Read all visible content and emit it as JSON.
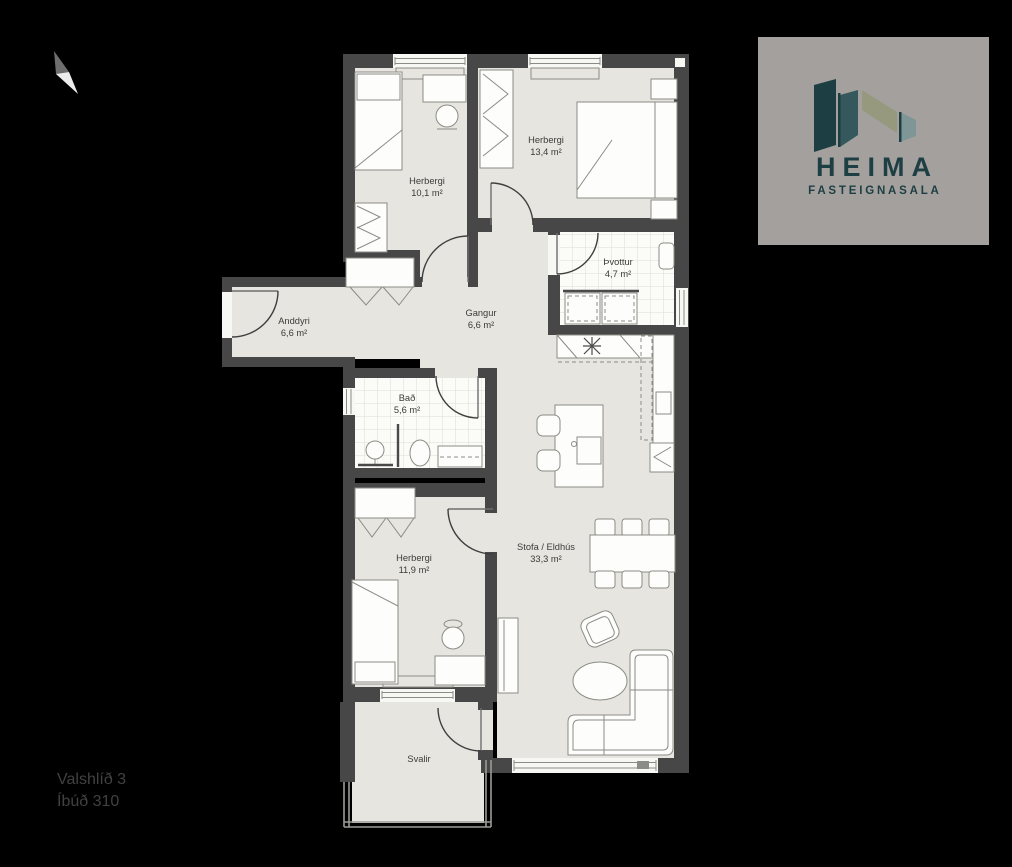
{
  "floorplan": {
    "rooms": [
      {
        "id": "bedroom-1",
        "name": "Herbergi",
        "area": "10,1 m²"
      },
      {
        "id": "bedroom-2",
        "name": "Herbergi",
        "area": "13,4 m²"
      },
      {
        "id": "laundry",
        "name": "Þvottur",
        "area": "4,7 m²"
      },
      {
        "id": "hallway",
        "name": "Gangur",
        "area": "6,6 m²"
      },
      {
        "id": "entrance",
        "name": "Anddyri",
        "area": "6,6 m²"
      },
      {
        "id": "bathroom",
        "name": "Bað",
        "area": "5,6 m²"
      },
      {
        "id": "bedroom-3",
        "name": "Herbergi",
        "area": "11,9 m²"
      },
      {
        "id": "living-kitchen",
        "name": "Stofa / Eldhús",
        "area": "33,3 m²"
      },
      {
        "id": "balcony",
        "name": "Svalir",
        "area": ""
      }
    ]
  },
  "logo": {
    "brand": "HEIMA",
    "tagline": "FASTEIGNASALA"
  },
  "footer": {
    "address": "Valshlíð 3",
    "unit": "Íbúð 310"
  },
  "colors": {
    "background": "#000000",
    "wall": "#474747",
    "floor": "#e6e5df",
    "tile": "#fbfbf8",
    "logo_panel": "#a3a09e",
    "logo_teal_dark": "#1d3e42",
    "logo_teal_mid": "#34585c",
    "logo_sage": "#97997f",
    "logo_gray_teal": "#7f9697",
    "label_text": "#3b3b38",
    "footer_text": "#414141"
  }
}
